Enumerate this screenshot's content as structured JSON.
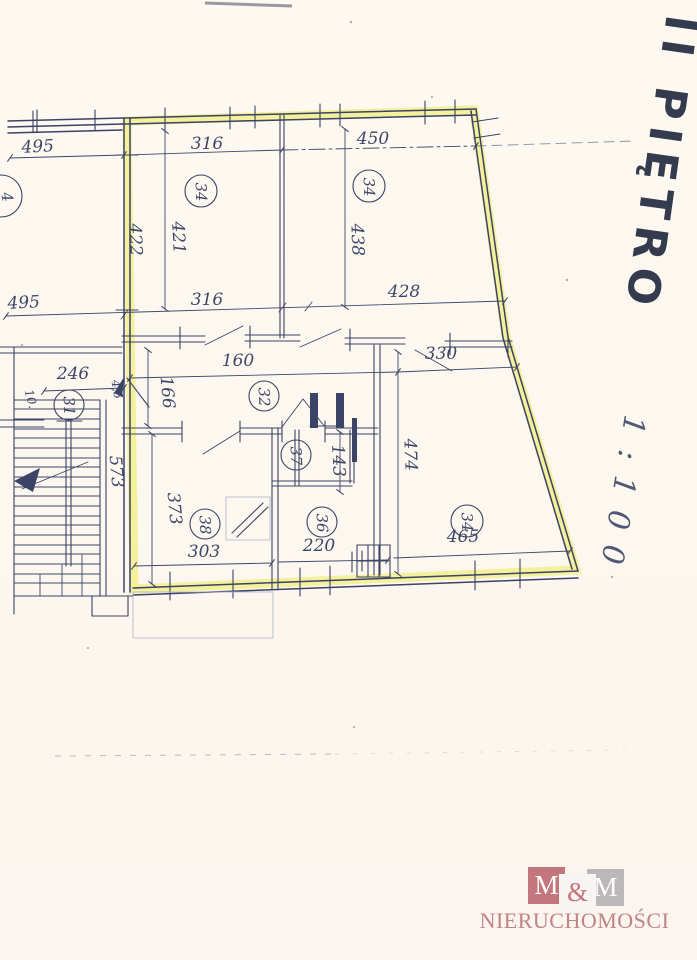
{
  "title": {
    "floor": "II PIĘTRO",
    "scale": "1:100"
  },
  "plan": {
    "dims": {
      "d495_top": "495",
      "d316_top": "316",
      "d450_top": "450",
      "d422": "422",
      "d421": "421",
      "d438": "438",
      "d495_mid": "495",
      "d316_mid": "316",
      "d428": "428",
      "d246": "246",
      "d160": "160",
      "d330": "330",
      "d166": "166",
      "d143": "143",
      "d474": "474",
      "d573": "573",
      "d373": "373",
      "d303": "303",
      "d220": "220",
      "d465": "465"
    },
    "annotations": {
      "wall_note": "4,5",
      "stair_note": "10."
    },
    "rooms": {
      "stairs": "31",
      "room_top_left": "34",
      "room_top_right": "34",
      "hall": "32",
      "bathroom": "37",
      "room_303": "38",
      "room_220": "36",
      "room_465": "34",
      "partial_left": "4"
    }
  },
  "logo": {
    "m1": "M",
    "amp": "&",
    "m2": "M",
    "name": "NIERUCHOMOŚCI"
  },
  "colors": {
    "ink": "#3b4366",
    "ink2": "#3f4769",
    "marker": "#262d43",
    "hl": "#f2ee8d",
    "logo_rose": "#c4767d",
    "logo_text": "#bf838a",
    "logo_gray": "#bcb8b9"
  }
}
